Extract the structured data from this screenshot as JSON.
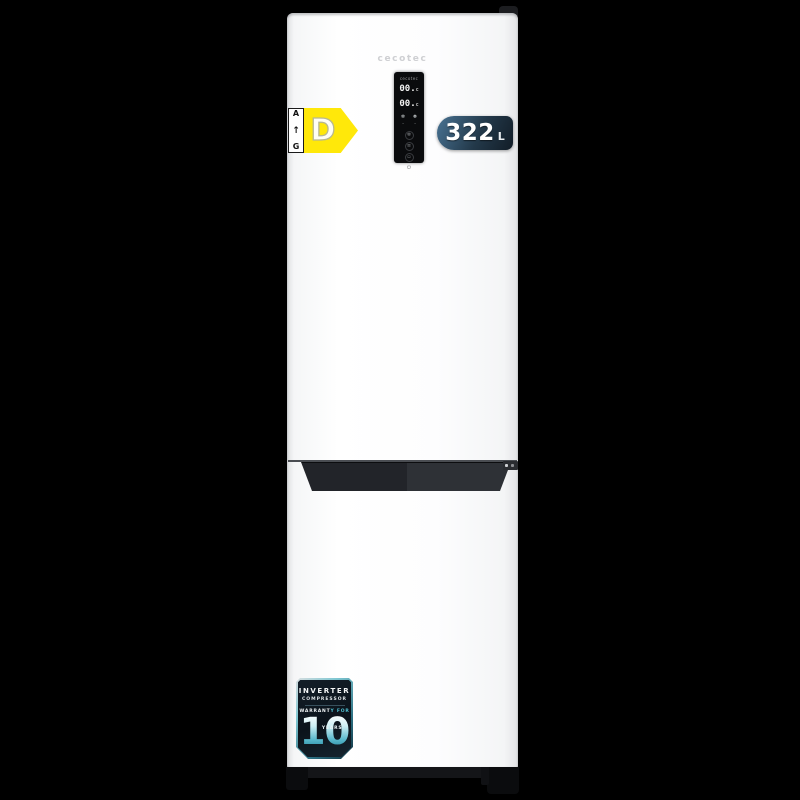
{
  "background_color": "#000000",
  "fridge": {
    "brand_logo": "cecotec",
    "body_color": "#ffffff"
  },
  "control_panel": {
    "brand_label": "cecotec",
    "fridge_temp": "00.",
    "freezer_temp": "00.",
    "mode_icons": [
      {
        "name": "snowflake-icon",
        "glyph": "❄"
      },
      {
        "name": "super-freeze-icon",
        "glyph": "❅"
      },
      {
        "name": "indicator-dot-left",
        "glyph": "·"
      },
      {
        "name": "indicator-dot-right",
        "glyph": "·"
      }
    ],
    "buttons": [
      {
        "name": "fridge-zone-button",
        "glyph": "❄"
      },
      {
        "name": "freezer-zone-button",
        "glyph": "≡"
      },
      {
        "name": "mode-button",
        "glyph": "▫"
      }
    ],
    "power_glyph": "⏻"
  },
  "energy_label": {
    "rating": "D",
    "scale_top": "A",
    "scale_bottom": "G",
    "arrow_glyph": "↑",
    "arrow_color": "#ffe80a"
  },
  "capacity_badge": {
    "value": "322",
    "unit": "L",
    "color_dark": "#14202b",
    "color_light": "#456d8c"
  },
  "warranty_badge": {
    "line1": "INVERTER",
    "line2": "COMPRESSOR",
    "line3_white": "WARRANT",
    "line3_teal": "Y FOR",
    "years_value": "10",
    "years_label": "YEARS",
    "teal_color": "#4fc0d2"
  }
}
